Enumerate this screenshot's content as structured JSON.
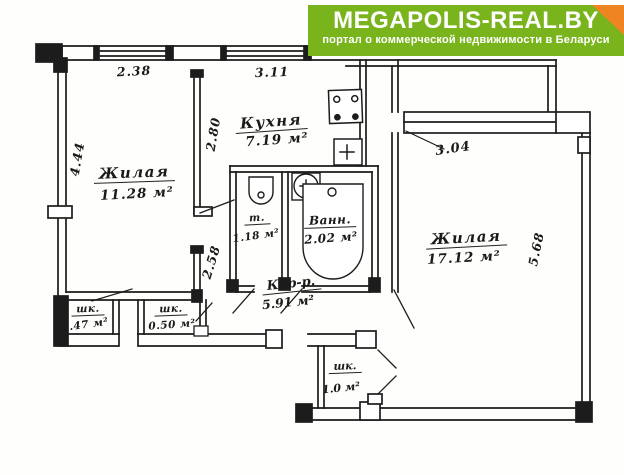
{
  "watermark": {
    "title": "MEGAPOLIS-REAL.BY",
    "subtitle": "портал о коммерческой недвижимости в Беларуси"
  },
  "plan": {
    "rooms": {
      "living1": {
        "name": "Жилая",
        "area": "11.28 м²"
      },
      "kitchen": {
        "name": "Кухня",
        "area": "7.19 м²"
      },
      "living2": {
        "name": "Жилая",
        "area": "17.12 м²"
      },
      "toilet": {
        "name": "т.",
        "area": "1.18 м²"
      },
      "bath": {
        "name": "Ванн.",
        "area": "2.02 м²"
      },
      "corridor": {
        "name": "Кор-р.",
        "area": "5.91 м²"
      },
      "closet1": {
        "name": "шк.",
        "area": "0.47 м²"
      },
      "closet2": {
        "name": "шк.",
        "area": "0.50 м²"
      },
      "closet3": {
        "name": "шк.",
        "area": "1.0 м²"
      }
    },
    "dimensions": {
      "room1_width": "2.38",
      "kitchen_width": "3.11",
      "room1_height": "4.44",
      "kitchen_height": "2.80",
      "hall_wall": "2.58",
      "room2_width": "3.04",
      "room2_height": "5.68"
    },
    "fixtures": [
      "stove",
      "kitchen-sink",
      "toilet",
      "wash-basin",
      "bathtub",
      "built-in-wardrobe"
    ]
  },
  "colors": {
    "watermark_green": "#79b41d",
    "watermark_fold_orange": "#ee8422",
    "ink": "#1c1c1c",
    "paper": "#fefefc"
  }
}
